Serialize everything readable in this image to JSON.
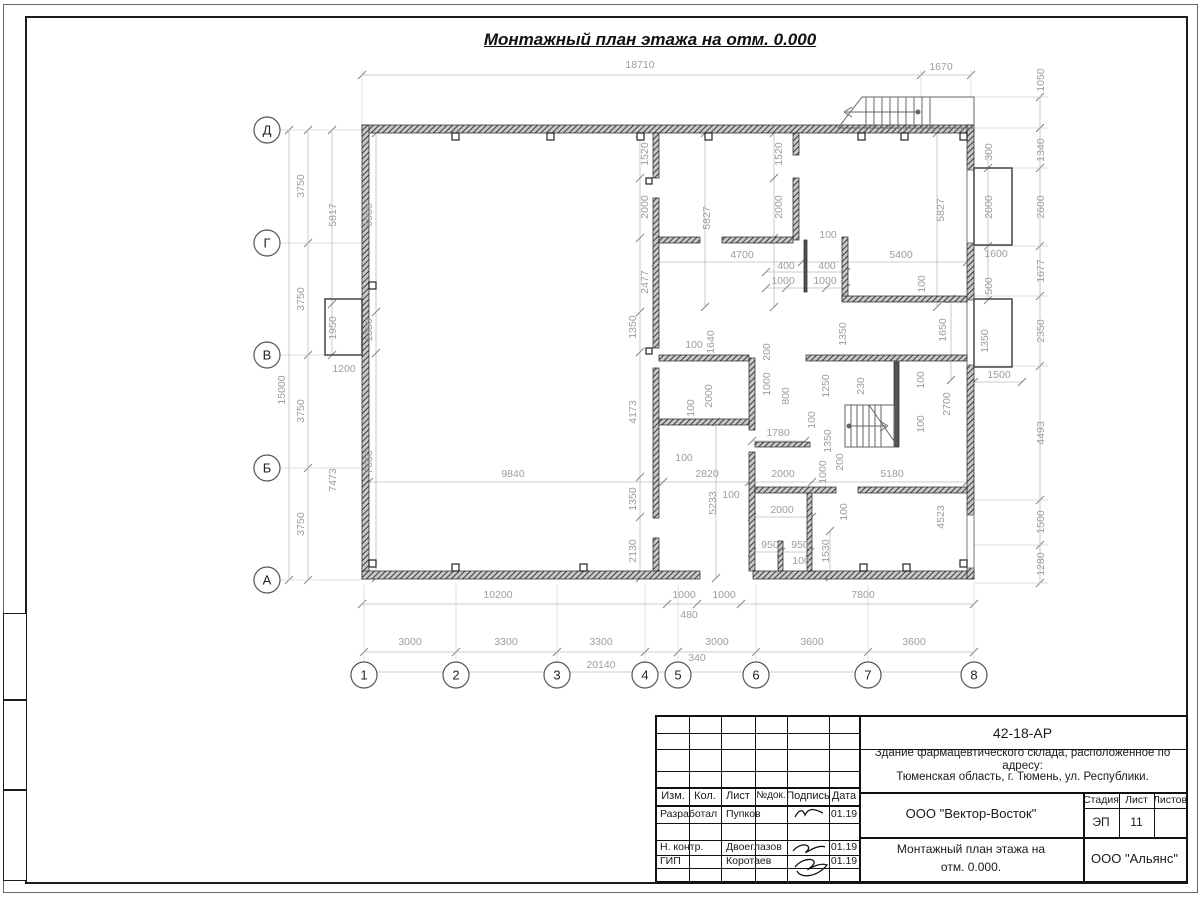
{
  "sheet": {
    "drawing_title": "Монтажный план этажа на отм. 0.000"
  },
  "plan": {
    "row_axes": [
      {
        "label": "Д",
        "y": 130
      },
      {
        "label": "Г",
        "y": 243
      },
      {
        "label": "В",
        "y": 355
      },
      {
        "label": "Б",
        "y": 468
      },
      {
        "label": "А",
        "y": 580
      }
    ],
    "col_axes": [
      {
        "label": "1",
        "x": 364
      },
      {
        "label": "2",
        "x": 456
      },
      {
        "label": "3",
        "x": 557
      },
      {
        "label": "4",
        "x": 645
      },
      {
        "label": "5",
        "x": 678
      },
      {
        "label": "6",
        "x": 756
      },
      {
        "label": "7",
        "x": 868
      },
      {
        "label": "8",
        "x": 974
      }
    ],
    "dimensions": [
      {
        "t": "18710",
        "x": 640,
        "y": 68
      },
      {
        "t": "1670",
        "x": 941,
        "y": 70
      },
      {
        "t": "1050",
        "x": 1044,
        "y": 80,
        "r": 1
      },
      {
        "t": "1340",
        "x": 1044,
        "y": 150,
        "r": 1
      },
      {
        "t": "2600",
        "x": 1044,
        "y": 207,
        "r": 1
      },
      {
        "t": "1677",
        "x": 1044,
        "y": 271,
        "r": 1
      },
      {
        "t": "2350",
        "x": 1044,
        "y": 331,
        "r": 1
      },
      {
        "t": "4493",
        "x": 1044,
        "y": 433,
        "r": 1
      },
      {
        "t": "1500",
        "x": 1044,
        "y": 522,
        "r": 1
      },
      {
        "t": "1280",
        "x": 1044,
        "y": 564,
        "r": 1
      },
      {
        "t": "3750",
        "x": 304,
        "y": 186,
        "r": 1
      },
      {
        "t": "3750",
        "x": 304,
        "y": 299,
        "r": 1
      },
      {
        "t": "3750",
        "x": 304,
        "y": 411,
        "r": 1
      },
      {
        "t": "3750",
        "x": 304,
        "y": 524,
        "r": 1
      },
      {
        "t": "15000",
        "x": 285,
        "y": 390,
        "r": 1
      },
      {
        "t": "5817",
        "x": 336,
        "y": 215,
        "r": 1
      },
      {
        "t": "1950",
        "x": 336,
        "y": 328,
        "r": 1
      },
      {
        "t": "1200",
        "x": 344,
        "y": 372
      },
      {
        "t": "7473",
        "x": 336,
        "y": 480,
        "r": 1
      },
      {
        "t": "6000",
        "x": 372,
        "y": 215,
        "r": 1
      },
      {
        "t": "1350",
        "x": 372,
        "y": 330,
        "r": 1
      },
      {
        "t": "7650",
        "x": 372,
        "y": 462,
        "r": 1
      },
      {
        "t": "1350",
        "x": 636,
        "y": 327,
        "r": 1
      },
      {
        "t": "4173",
        "x": 636,
        "y": 412,
        "r": 1
      },
      {
        "t": "1350",
        "x": 636,
        "y": 499,
        "r": 1
      },
      {
        "t": "2130",
        "x": 636,
        "y": 551,
        "r": 1
      },
      {
        "t": "9840",
        "x": 513,
        "y": 477
      },
      {
        "t": "1520",
        "x": 648,
        "y": 154,
        "r": 1
      },
      {
        "t": "2000",
        "x": 648,
        "y": 207,
        "r": 1
      },
      {
        "t": "2477",
        "x": 648,
        "y": 282,
        "r": 1
      },
      {
        "t": "5827",
        "x": 710,
        "y": 218,
        "r": 1
      },
      {
        "t": "1520",
        "x": 782,
        "y": 154,
        "r": 1
      },
      {
        "t": "2000",
        "x": 782,
        "y": 207,
        "r": 1
      },
      {
        "t": "100",
        "x": 828,
        "y": 238
      },
      {
        "t": "4700",
        "x": 742,
        "y": 258
      },
      {
        "t": "5400",
        "x": 901,
        "y": 258
      },
      {
        "t": "400",
        "x": 786,
        "y": 269
      },
      {
        "t": "400",
        "x": 827,
        "y": 269
      },
      {
        "t": "1000",
        "x": 783,
        "y": 284
      },
      {
        "t": "1000",
        "x": 825,
        "y": 284
      },
      {
        "t": "5827",
        "x": 944,
        "y": 210,
        "r": 1
      },
      {
        "t": "300",
        "x": 992,
        "y": 152,
        "r": 1
      },
      {
        "t": "2000",
        "x": 992,
        "y": 207,
        "r": 1
      },
      {
        "t": "1600",
        "x": 996,
        "y": 257
      },
      {
        "t": "500",
        "x": 992,
        "y": 286,
        "r": 1
      },
      {
        "t": "100",
        "x": 925,
        "y": 284,
        "r": 1
      },
      {
        "t": "1650",
        "x": 946,
        "y": 330,
        "r": 1
      },
      {
        "t": "1350",
        "x": 846,
        "y": 334,
        "r": 1
      },
      {
        "t": "1350",
        "x": 988,
        "y": 341,
        "r": 1
      },
      {
        "t": "1500",
        "x": 999,
        "y": 378
      },
      {
        "t": "2700",
        "x": 950,
        "y": 404,
        "r": 1
      },
      {
        "t": "100",
        "x": 924,
        "y": 380,
        "r": 1
      },
      {
        "t": "100",
        "x": 924,
        "y": 424,
        "r": 1
      },
      {
        "t": "230",
        "x": 864,
        "y": 386,
        "r": 1
      },
      {
        "t": "1250",
        "x": 829,
        "y": 386,
        "r": 1
      },
      {
        "t": "1350",
        "x": 831,
        "y": 441,
        "r": 1
      },
      {
        "t": "100",
        "x": 815,
        "y": 420,
        "r": 1
      },
      {
        "t": "100",
        "x": 694,
        "y": 348
      },
      {
        "t": "1640",
        "x": 714,
        "y": 342,
        "r": 1
      },
      {
        "t": "200",
        "x": 770,
        "y": 352,
        "r": 1
      },
      {
        "t": "1000",
        "x": 770,
        "y": 384,
        "r": 1
      },
      {
        "t": "800",
        "x": 789,
        "y": 396,
        "r": 1
      },
      {
        "t": "2000",
        "x": 712,
        "y": 396,
        "r": 1
      },
      {
        "t": "100",
        "x": 694,
        "y": 408,
        "r": 1
      },
      {
        "t": "1780",
        "x": 778,
        "y": 436
      },
      {
        "t": "100",
        "x": 684,
        "y": 461
      },
      {
        "t": "2820",
        "x": 707,
        "y": 477
      },
      {
        "t": "5233",
        "x": 716,
        "y": 503,
        "r": 1
      },
      {
        "t": "100",
        "x": 731,
        "y": 498
      },
      {
        "t": "2000",
        "x": 783,
        "y": 477
      },
      {
        "t": "2000",
        "x": 782,
        "y": 513
      },
      {
        "t": "950",
        "x": 770,
        "y": 548
      },
      {
        "t": "950",
        "x": 800,
        "y": 548
      },
      {
        "t": "100",
        "x": 801,
        "y": 564
      },
      {
        "t": "1530",
        "x": 829,
        "y": 551,
        "r": 1
      },
      {
        "t": "100",
        "x": 847,
        "y": 512,
        "r": 1
      },
      {
        "t": "200",
        "x": 843,
        "y": 462,
        "r": 1
      },
      {
        "t": "1000",
        "x": 826,
        "y": 472,
        "r": 1
      },
      {
        "t": "5180",
        "x": 892,
        "y": 477
      },
      {
        "t": "4523",
        "x": 944,
        "y": 517,
        "r": 1
      },
      {
        "t": "10200",
        "x": 498,
        "y": 598
      },
      {
        "t": "1000",
        "x": 684,
        "y": 598
      },
      {
        "t": "1000",
        "x": 724,
        "y": 598
      },
      {
        "t": "480",
        "x": 689,
        "y": 618
      },
      {
        "t": "7800",
        "x": 863,
        "y": 598
      },
      {
        "t": "3000",
        "x": 410,
        "y": 645
      },
      {
        "t": "3300",
        "x": 506,
        "y": 645
      },
      {
        "t": "3300",
        "x": 601,
        "y": 645
      },
      {
        "t": "3000",
        "x": 717,
        "y": 645
      },
      {
        "t": "3600",
        "x": 812,
        "y": 645
      },
      {
        "t": "3600",
        "x": 914,
        "y": 645
      },
      {
        "t": "20140",
        "x": 601,
        "y": 668
      },
      {
        "t": "340",
        "x": 697,
        "y": 661
      }
    ]
  },
  "title_block": {
    "doc_number": "42-18-АР",
    "project_desc_line1": "Здание фармацевтического склада, расположенное по адресу:",
    "project_desc_line2": "Тюменская область, г. Тюмень, ул. Республики.",
    "header_cols": {
      "izm": "Изм.",
      "kol": "Кол.",
      "list": "Лист",
      "ndok": "№док.",
      "podpis": "Подпись",
      "data": "Дата"
    },
    "rows": [
      {
        "role": "Разработал",
        "name": "Пупков",
        "date": "01.19"
      },
      {
        "role": "Н. контр.",
        "name": "Двоеглазов",
        "date": "01.19"
      },
      {
        "role": "ГИП",
        "name": "Коротаев",
        "date": "01.19"
      }
    ],
    "organization": "ООО \"Вектор-Восток\"",
    "sheet_title_line1": "Монтажный план этажа на",
    "sheet_title_line2": "отм. 0.000.",
    "contractor": "ООО \"Альянс\"",
    "stage_label": "Стадия",
    "sheet_label": "Лист",
    "sheets_label": "Листов",
    "stage": "ЭП",
    "sheet_no": "11"
  }
}
